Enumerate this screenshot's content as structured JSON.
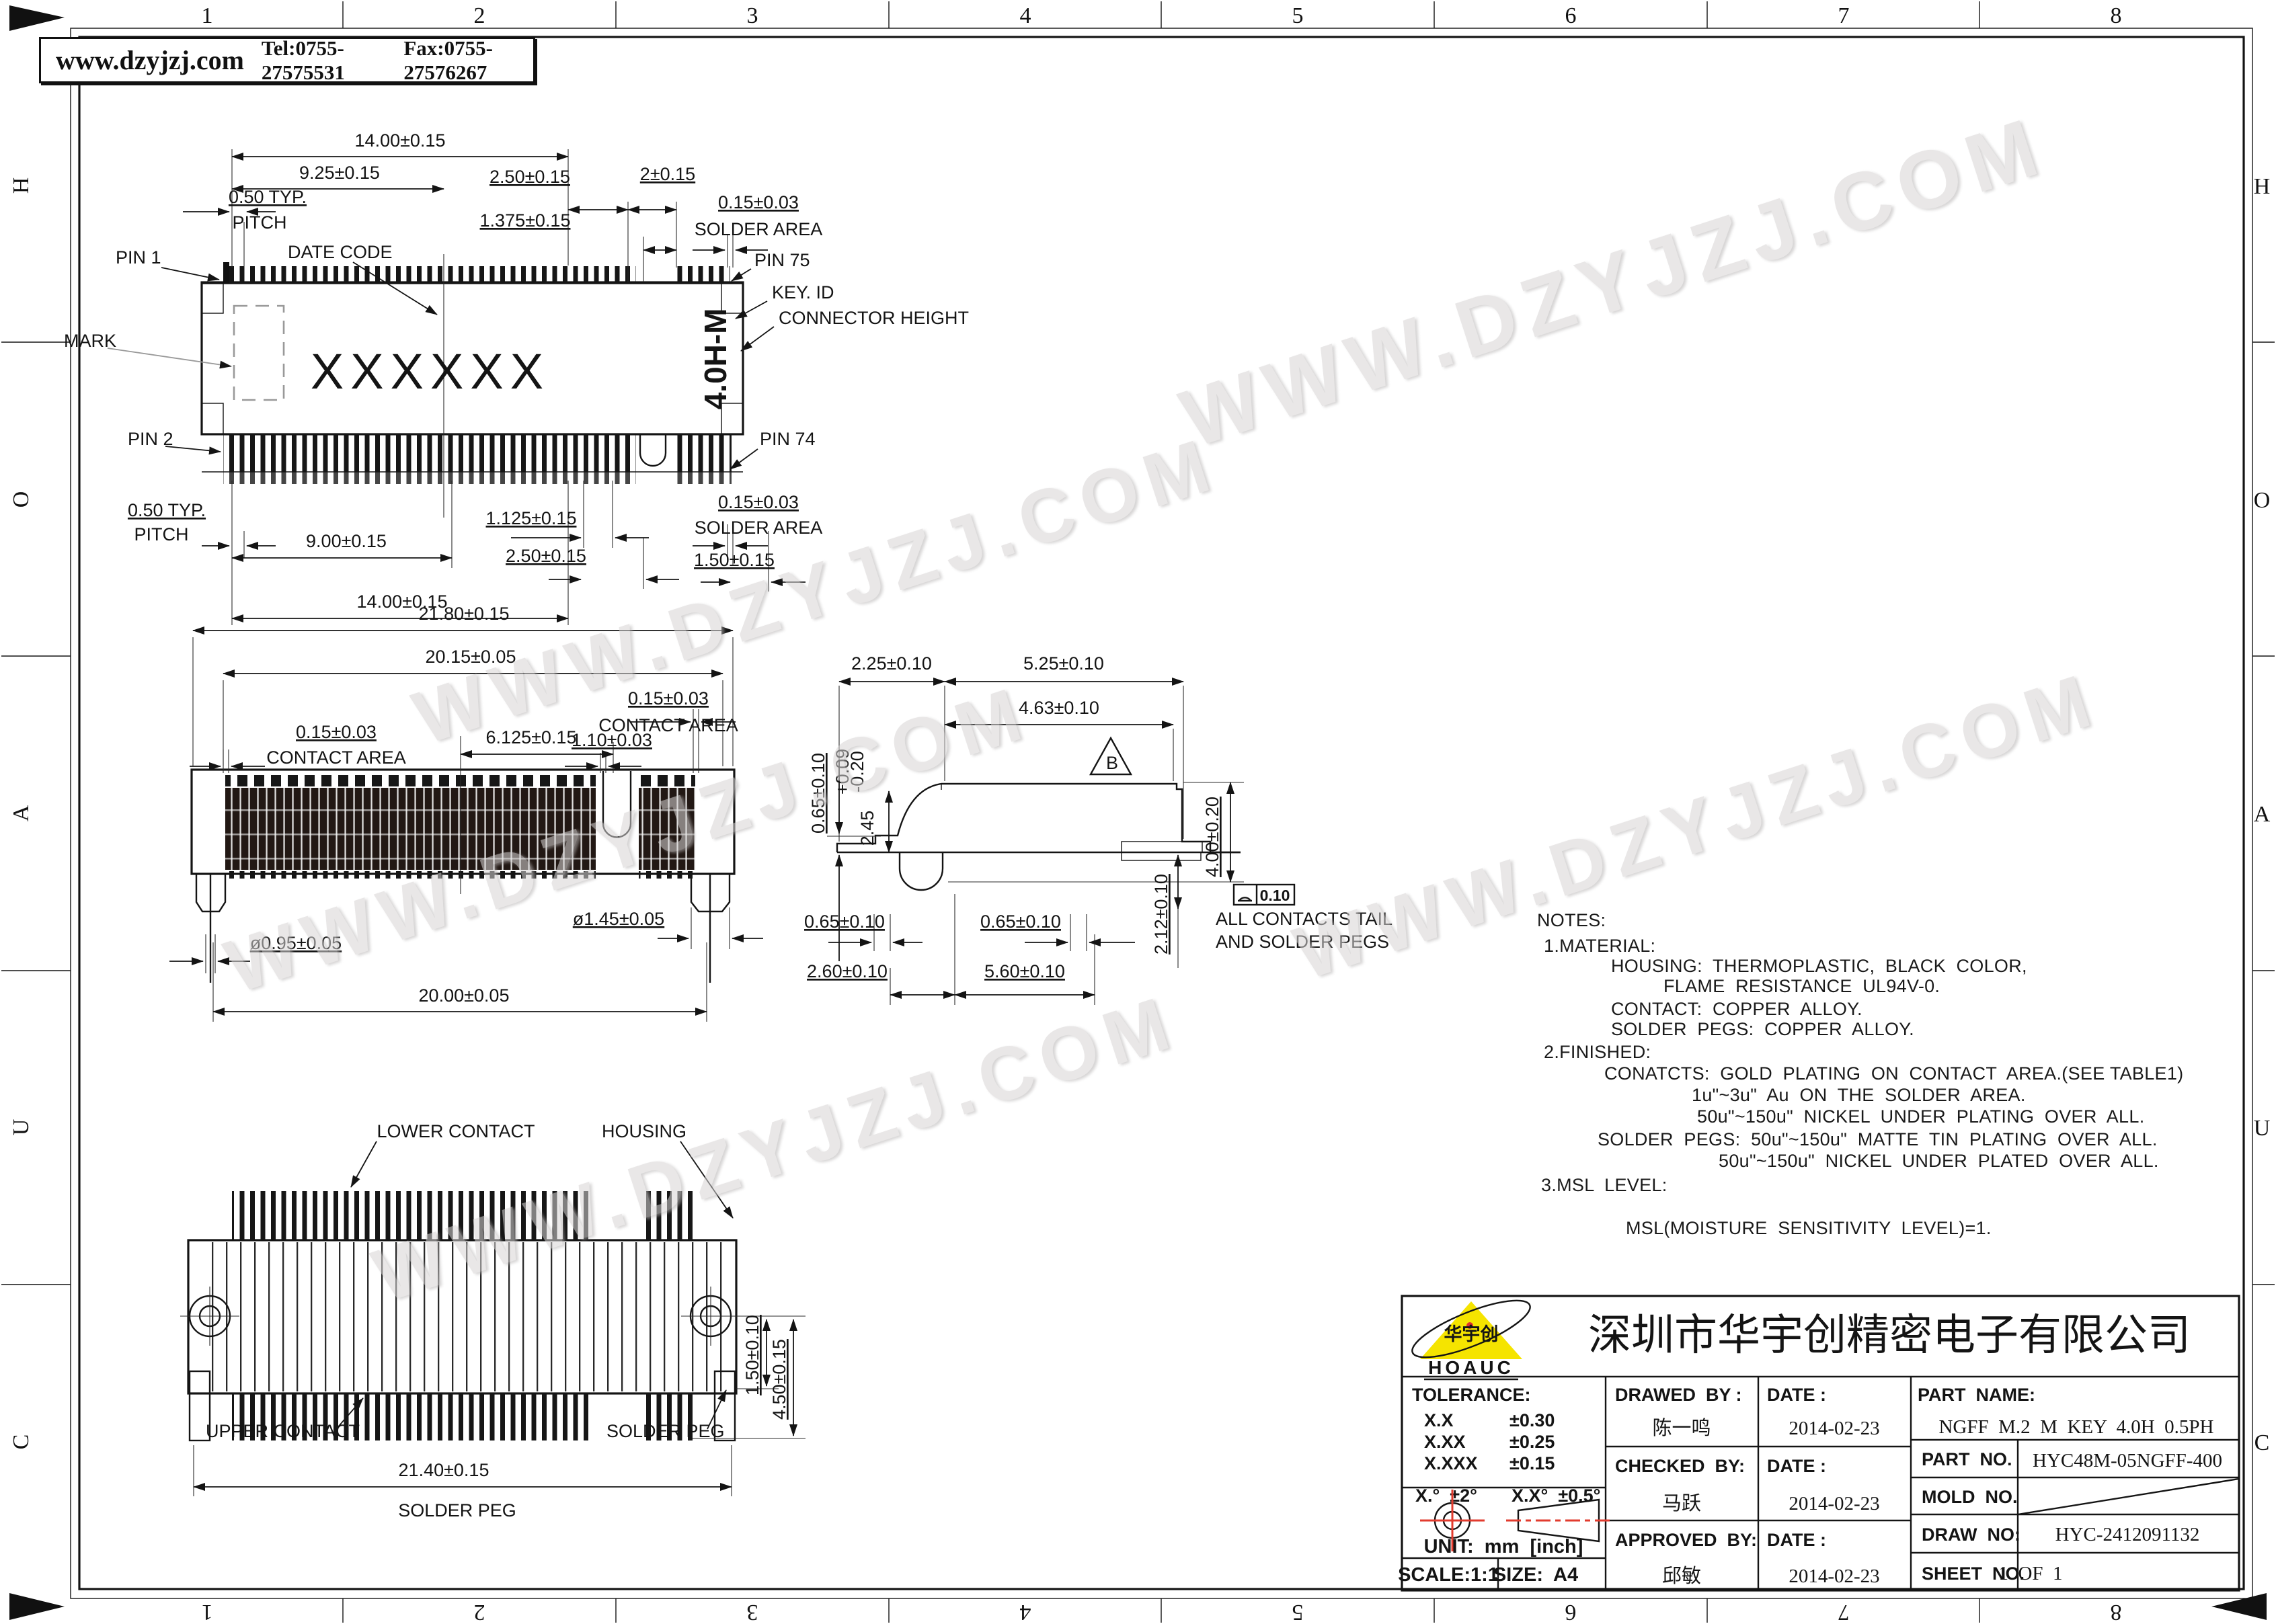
{
  "header": {
    "website": "www.dzyjzj.com",
    "tel": "Tel:0755-27575531",
    "fax": "Fax:0755-27576267"
  },
  "watermark": "WWW.DZYJZJ.COM",
  "frame": {
    "top_numbers": [
      "1",
      "2",
      "3",
      "4",
      "5",
      "6",
      "7",
      "8"
    ],
    "bottom_numbers": [
      "8",
      "7",
      "6",
      "5",
      "4",
      "3",
      "2",
      "1"
    ],
    "left_letters": [
      "H",
      "O",
      "A",
      "U",
      "C"
    ],
    "right_letters": [
      "H",
      "O",
      "A",
      "U",
      "C"
    ]
  },
  "top_view": {
    "dim_14": "14.00±0.15",
    "dim_925": "9.25±0.15",
    "dim_250_top": "2.50±0.15",
    "dim_2": "2±0.15",
    "pitch_1": "0.50 TYP.",
    "pitch_2": "PITCH",
    "dim_1375": "1.375±0.15",
    "solder_1": "0.15±0.03",
    "solder_2": "SOLDER AREA",
    "date_code": "DATE CODE",
    "pin1": "PIN 1",
    "pin75": "PIN 75",
    "key_id": "KEY. ID",
    "connector_height": "CONNECTOR HEIGHT",
    "mark": "MARK",
    "body_marking": "XXXXXX",
    "height_code": "4.0H-M",
    "pin2": "PIN 2",
    "pin74": "PIN 74",
    "pitch_b1": "0.50 TYP.",
    "pitch_b2": "PITCH",
    "dim_900": "9.00±0.15",
    "dim_1125": "1.125±0.15",
    "dim_250_bot": "2.50±0.15",
    "solder_b1": "0.15±0.03",
    "solder_b2": "SOLDER AREA",
    "dim_150": "1.50±0.15",
    "dim_14_bot": "14.00±0.15"
  },
  "front_view": {
    "dim_2180": "21.80±0.15",
    "dim_2015": "20.15±0.05",
    "contact_r1": "0.15±0.03",
    "contact_r2": "CONTACT AREA",
    "dim_6125": "6.125±0.15",
    "contact_l1": "0.15±0.03",
    "contact_l2": "CONTACT AREA",
    "dim_110": "1.10±0.03",
    "dim_d095": "ø0.95±0.05",
    "dim_d145": "ø1.45±0.05",
    "dim_2000": "20.00±0.05"
  },
  "side_view": {
    "dim_225": "2.25±0.10",
    "dim_525": "5.25±0.10",
    "dim_463": "4.63±0.10",
    "dim_245": "2.45",
    "dim_245_t1": "+0.09",
    "dim_245_t2": "-0.20",
    "dim_065_left": "0.65±0.10",
    "dim_400": "4.00±0.20",
    "datum_b": "B",
    "flatness": "0.10",
    "note_1": "ALL CONTACTS TAIL",
    "note_2": "AND SOLDER PEGS",
    "dim_065_b1": "0.65±0.10",
    "dim_065_b2": "0.65±0.10",
    "dim_212": "2.12±0.10",
    "dim_260": "2.60±0.10",
    "dim_560": "5.60±0.10"
  },
  "bottom_view": {
    "lower_contact": "LOWER CONTACT",
    "housing": "HOUSING",
    "dim_150": "1.50±0.10",
    "dim_450": "4.50±0.15",
    "upper_contact": "UPPER CONTACT",
    "solder_peg": "SOLDER PEG",
    "dim_2140": "21.40±0.15",
    "solder_peg2": "SOLDER PEG"
  },
  "notes": {
    "title": "NOTES:",
    "l1": "1.MATERIAL:",
    "l2": "HOUSING:  THERMOPLASTIC,  BLACK  COLOR,",
    "l3": "FLAME  RESISTANCE  UL94V-0.",
    "l4": "CONTACT:  COPPER  ALLOY.",
    "l5": "SOLDER  PEGS:  COPPER  ALLOY.",
    "l6": "2.FINISHED:",
    "l7": "CONATCTS:  GOLD  PLATING  ON  CONTACT  AREA.(SEE TABLE1)",
    "l8": "1u\"~3u\"  Au  ON  THE  SOLDER  AREA.",
    "l9": "50u\"~150u\"  NICKEL  UNDER  PLATING  OVER  ALL.",
    "l10": "SOLDER  PEGS:  50u\"~150u\"  MATTE  TIN  PLATING  OVER  ALL.",
    "l11": "50u\"~150u\"  NICKEL  UNDER  PLATED  OVER  ALL.",
    "l12": "3.MSL  LEVEL:",
    "l13": "MSL(MOISTURE  SENSITIVITY  LEVEL)=1."
  },
  "title_block": {
    "logo_brand": "HOAUC",
    "logo_cn": "华宇创",
    "company": "深圳市华宇创精密电子有限公司",
    "tolerance_label": "TOLERANCE:",
    "tol_rows": [
      [
        "X.X",
        "±0.30"
      ],
      [
        "X.XX",
        "±0.25"
      ],
      [
        "X.XXX",
        "±0.15"
      ]
    ],
    "tol_ang1": "X.°  ±2°",
    "tol_ang2": "X.X°  ±0.5°",
    "unit": "UNIT:  mm  [inch]",
    "scale": "SCALE:1:1",
    "size": "SIZE:  A4",
    "drawed_by": "DRAWED  BY :",
    "checked_by": "CHECKED  BY:",
    "approved_by": "APPROVED  BY:",
    "date_label1": "DATE :",
    "date_label2": "DATE :",
    "date_label3": "DATE :",
    "drawer": "陈一鸣",
    "checker": "马跃",
    "approver": "邱敏",
    "date1": "2014-02-23",
    "date2": "2014-02-23",
    "date3": "2014-02-23",
    "part_name_label": "PART  NAME:",
    "part_name": "NGFF  M.2  M  KEY  4.0H  0.5PH",
    "part_no_label": "PART  NO.",
    "part_no": "HYC48M-05NGFF-400",
    "mold_no_label": "MOLD  NO.",
    "draw_no_label": "DRAW  NO:",
    "draw_no": "HYC-2412091132",
    "sheet_no_label": "SHEET  NO.",
    "sheet_no": "1  OF  1"
  }
}
